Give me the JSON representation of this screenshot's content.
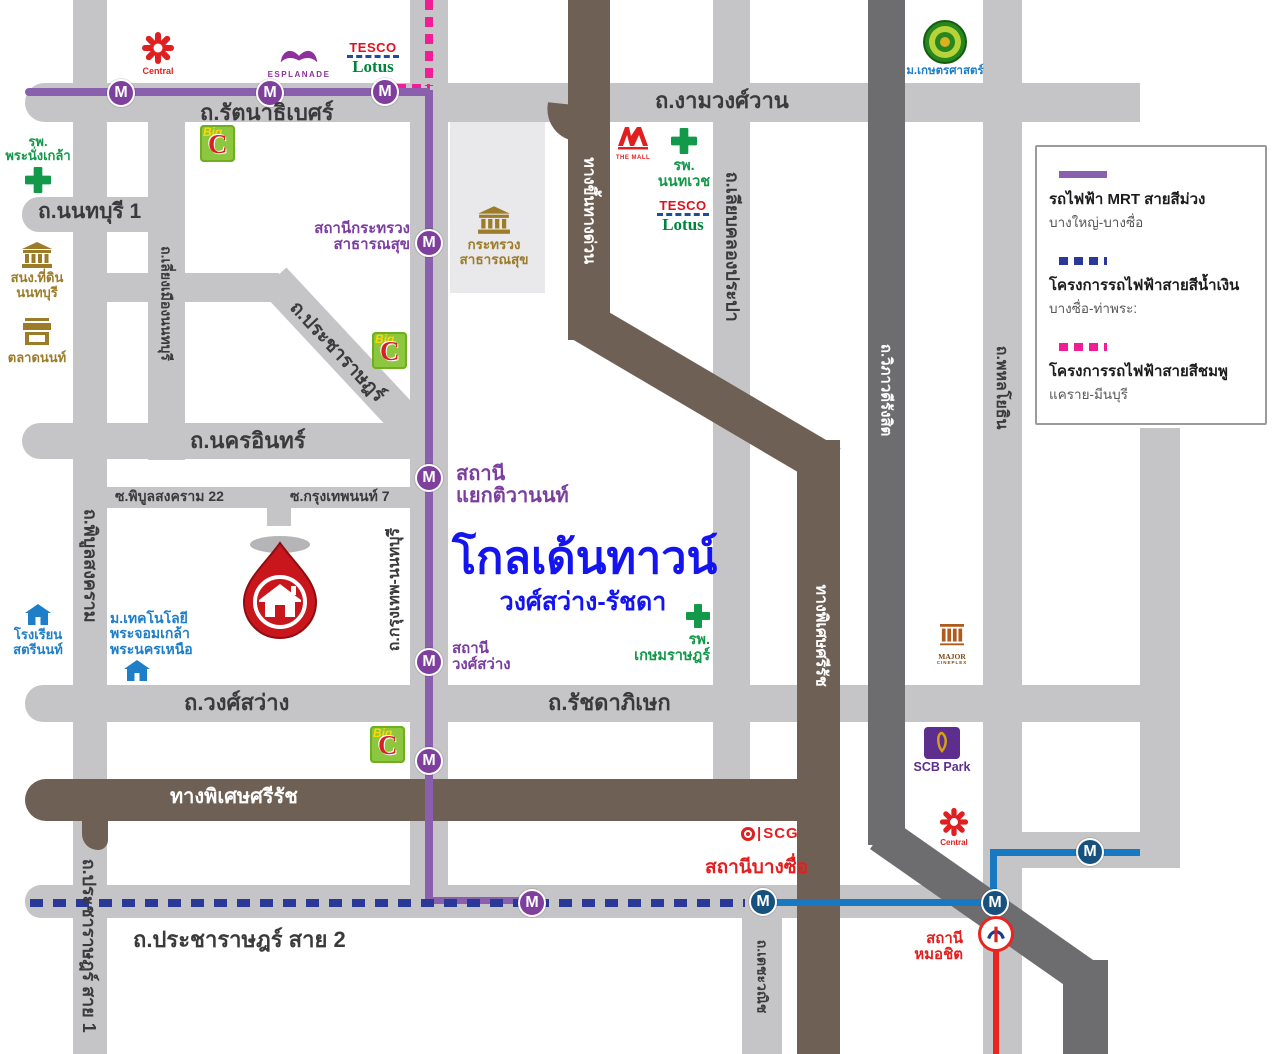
{
  "colors": {
    "road_light": "#c5c5c7",
    "road_dark": "#6d6d6f",
    "expressway_brown": "#6e6054",
    "mrt_purple_line": "#8a5fae",
    "blue_line_project": "#2a3898",
    "pink_line_project": "#f01e96",
    "mrt_blue_line": "#1878c2",
    "bts_red_line": "#e8251f",
    "title_blue": "#1414f0"
  },
  "title": {
    "project": "โกลเด้นทาวน์",
    "subtitle": "วงศ์สว่าง-รัชดา"
  },
  "legend": {
    "items": [
      {
        "label": "รถไฟฟ้า MRT สายสีม่วง",
        "sub": "บางใหญ่-บางซื่อ",
        "style": "solid-purple"
      },
      {
        "label": "โครงการรถไฟฟ้าสายสีน้ำเงิน",
        "sub": "บางซื่อ-ท่าพระ:",
        "style": "dashed-blue"
      },
      {
        "label": "โครงการรถไฟฟ้าสายสีชมพู",
        "sub": "แคราย-มีนบุรี",
        "style": "dashed-pink"
      }
    ]
  },
  "roads": {
    "rattanathibet": "ถ.รัตนาธิเบศร์",
    "ngamwongwan": "ถ.งามวงศ์วาน",
    "nonthaburi1": "ถ.นนทบุรี 1",
    "nakhon_in": "ถ.นครอินทร์",
    "soi_phibun22": "ซ.พิบูลสงคราม 22",
    "soi_krungthepnon7": "ซ.กรุงเทพนนท์ 7",
    "wong_sawang": "ถ.วงศ์สว่าง",
    "ratchadaphisek": "ถ.รัชดาภิเษก",
    "pracharat_sai2": "ถ.ประชาราษฎร์ สาย 2",
    "pracharat_sai1": "ถ.ประชาราษฎร์ สาย 1",
    "pracharat_diag": "ถ.ประชาราษฎร์",
    "phibunsongkhram": "ถ.พิบูลสงคราม",
    "liang_mueang": "ถ.เลี่ยงเมืองนนทบุรี",
    "krungthep_nonthaburi": "ถ.กรุงเทพ-นนทบุรี",
    "liap_khlong_prapa": "ถ.เลียบคลองประปา",
    "techawanit": "ถ.เตชะวณิช",
    "viphavadi": "ถ.วิภาวดีรังสิต",
    "phahonyothin": "ถ.พหลโยธิน",
    "srirat_expressway": "ทางพิเศษศรีรัช",
    "srirat_expressway_v": "ทางพิเศษศรีรัช",
    "expressway_ramp": "ทางขึ้นทางด่วน"
  },
  "stations": {
    "m": "M",
    "krasuang_line1": "สถานีกระทรวง",
    "krasuang_line2": "สาธารณสุข",
    "tiwanon_line1": "สถานี",
    "tiwanon_line2": "แยกติวานนท์",
    "wongsawang_line1": "สถานี",
    "wongsawang_line2": "วงศ์สว่าง",
    "bang_sue": "สถานีบางซื่อ",
    "mochit_line1": "สถานี",
    "mochit_line2": "หมอชิต"
  },
  "landmarks": {
    "central": "Central",
    "esplanade": "ESPLANADE",
    "tesco": "TESCO",
    "lotus": "Lotus",
    "bigc_big": "Big",
    "bigc_c": "C",
    "phranangklao_line1": "รพ.",
    "phranangklao_line2": "พระนั่งเกล้า",
    "land_office_line1": "สนง.ที่ดิน",
    "land_office_line2": "นนทบุรี",
    "talad_non": "ตลาดนนท์",
    "satrinon_line1": "โรงเรียน",
    "satrinon_line2": "สตรีนนท์",
    "kmutnb_line1": "ม.เทคโนโลยี",
    "kmutnb_line2": "พระจอมเกล้า",
    "kmutnb_line3": "พระนครเหนือ",
    "moph_line1": "กระทรวง",
    "moph_line2": "สาธารณสุข",
    "the_mall": "THE MALL",
    "nonthavej_line1": "รพ.",
    "nonthavej_line2": "นนทเวช",
    "kasetsart": "ม.เกษตรศาสตร์",
    "kasemrat_line1": "รพ.",
    "kasemrat_line2": "เกษมราษฎร์",
    "major_line1": "MAJOR",
    "major_line2": "CINEPLEX",
    "scb_park": "SCB Park",
    "scg": "SCG"
  }
}
